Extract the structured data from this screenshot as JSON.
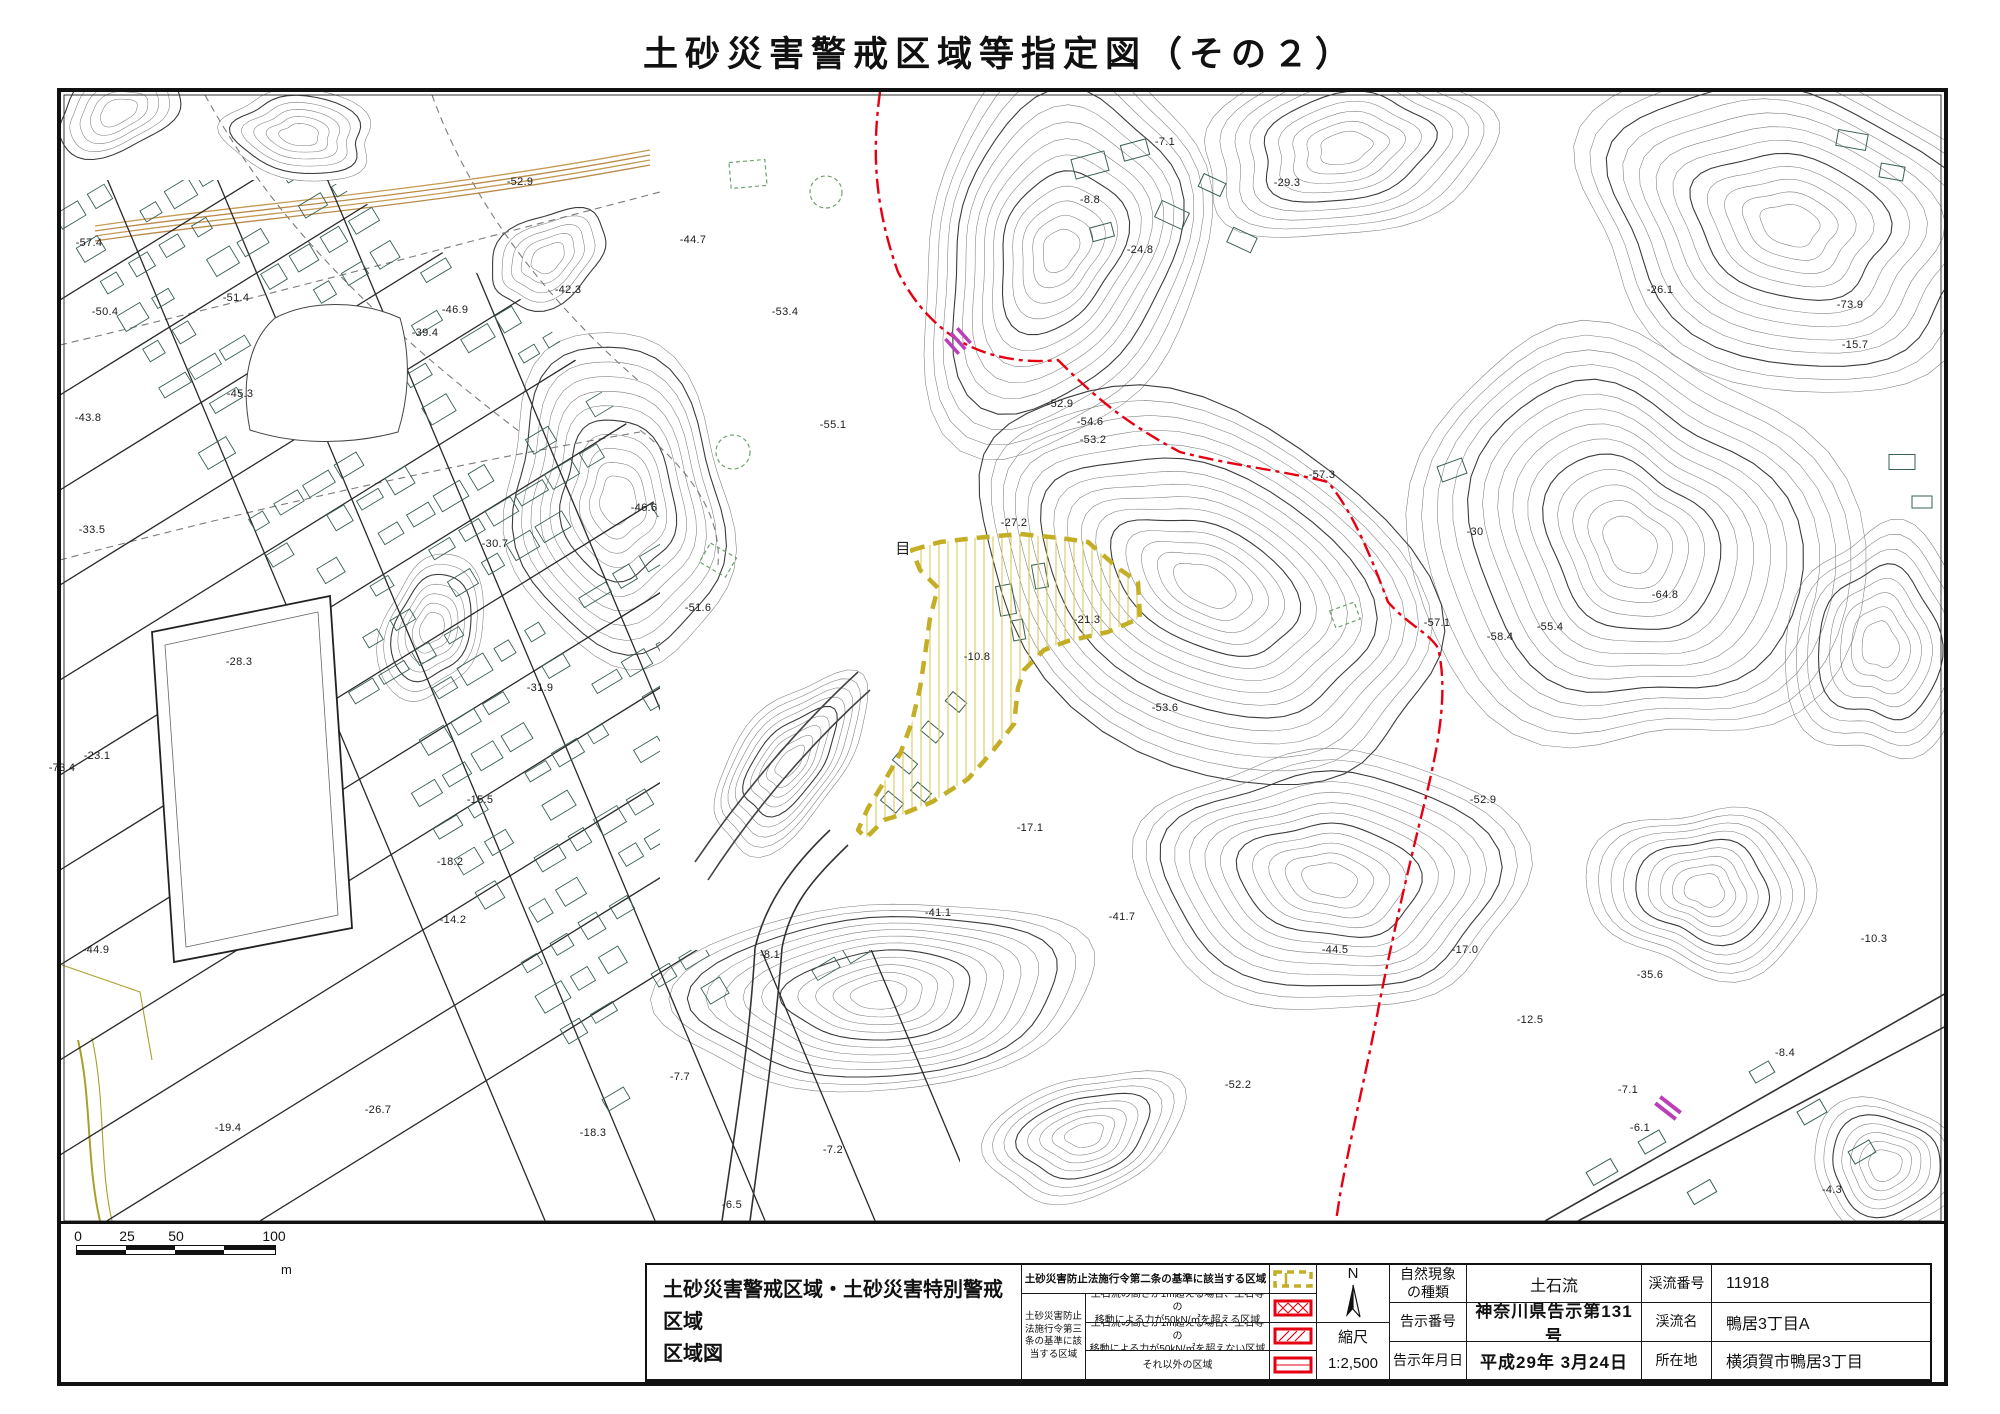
{
  "page": {
    "title": "土砂災害警戒区域等指定図（その２）"
  },
  "scalebar": {
    "ticks": [
      "0",
      "25",
      "50",
      "100"
    ],
    "unit": "m"
  },
  "legend": {
    "title_line1": "土砂災害警戒区域・土砂災害特別警戒区域",
    "title_line2": "区域図",
    "row1_label": "土砂災害防止法施行令第二条の基準に該当する区域",
    "group_label": [
      "土砂災害防止",
      "法施行令第三",
      "条の基準に該",
      "当する区域"
    ],
    "rows": [
      {
        "line1": "土石流の高さが1m超える場合、土石等の",
        "line2": "移動による力が50kN/㎡を超える区域"
      },
      {
        "line1": "土石流の高さが1m超える場合、土石等の",
        "line2": "移動による力が50kN/㎡を超えない区域"
      },
      {
        "line1": "それ以外の区域",
        "line2": ""
      }
    ]
  },
  "compass": {
    "north": "N",
    "scale_label": "縮尺",
    "scale_value": "1:2,500"
  },
  "info": {
    "rows": [
      {
        "l1": "自然現象",
        "l1b": "の種類",
        "v1": "土石流",
        "l2": "渓流番号",
        "v2": "11918"
      },
      {
        "l1": "告示番号",
        "l1b": "",
        "v1": "神奈川県告示第131号",
        "l2": "渓流名",
        "v2": "鴨居3丁目A"
      },
      {
        "l1": "告示年月日",
        "l1b": "",
        "v1": "平成29年 3月24日",
        "l2": "所在地",
        "v2": "横須賀市鴨居3丁目"
      }
    ]
  },
  "colors": {
    "warning_yellow": "#c3ae25",
    "hatch_yellow": "#d4c44e",
    "special_red": "#e60012",
    "boundary_red": "#e60012",
    "building_teal": "#3a5f55",
    "magenta": "#bb3fbb"
  },
  "map": {
    "area_label": {
      "x": 903,
      "y": 548,
      "t": "目"
    },
    "elevation_labels": [
      {
        "x": 89,
        "y": 243,
        "t": "-57.4"
      },
      {
        "x": 105,
        "y": 312,
        "t": "-50.4"
      },
      {
        "x": 236,
        "y": 298,
        "t": "-51.4"
      },
      {
        "x": 88,
        "y": 418,
        "t": "-43.8"
      },
      {
        "x": 240,
        "y": 394,
        "t": "-45.3"
      },
      {
        "x": 92,
        "y": 530,
        "t": "-33.5"
      },
      {
        "x": 239,
        "y": 662,
        "t": "-28.3"
      },
      {
        "x": 97,
        "y": 756,
        "t": "-23.1"
      },
      {
        "x": 62,
        "y": 768,
        "t": "-73.4"
      },
      {
        "x": 96,
        "y": 950,
        "t": "-44.9"
      },
      {
        "x": 228,
        "y": 1128,
        "t": "-19.4"
      },
      {
        "x": 378,
        "y": 1110,
        "t": "-26.7"
      },
      {
        "x": 453,
        "y": 920,
        "t": "-14.2"
      },
      {
        "x": 450,
        "y": 862,
        "t": "-18.2"
      },
      {
        "x": 480,
        "y": 800,
        "t": "-15.5"
      },
      {
        "x": 540,
        "y": 688,
        "t": "-31.9"
      },
      {
        "x": 495,
        "y": 544,
        "t": "-30.7"
      },
      {
        "x": 425,
        "y": 333,
        "t": "-39.4"
      },
      {
        "x": 455,
        "y": 310,
        "t": "-46.9"
      },
      {
        "x": 520,
        "y": 182,
        "t": "-52.9"
      },
      {
        "x": 568,
        "y": 290,
        "t": "-42.3"
      },
      {
        "x": 693,
        "y": 240,
        "t": "-44.7"
      },
      {
        "x": 785,
        "y": 312,
        "t": "-53.4"
      },
      {
        "x": 644,
        "y": 508,
        "t": "-46.6"
      },
      {
        "x": 698,
        "y": 608,
        "t": "-51.6"
      },
      {
        "x": 833,
        "y": 425,
        "t": "-55.1"
      },
      {
        "x": 1060,
        "y": 404,
        "t": "-52.9"
      },
      {
        "x": 1090,
        "y": 422,
        "t": "-54.6"
      },
      {
        "x": 1093,
        "y": 440,
        "t": "-53.2"
      },
      {
        "x": 1014,
        "y": 523,
        "t": "-27.2"
      },
      {
        "x": 977,
        "y": 657,
        "t": "-10.8"
      },
      {
        "x": 1087,
        "y": 620,
        "t": "-21.3"
      },
      {
        "x": 1165,
        "y": 708,
        "t": "-53.6"
      },
      {
        "x": 1030,
        "y": 828,
        "t": "-17.1"
      },
      {
        "x": 938,
        "y": 913,
        "t": "-41.1"
      },
      {
        "x": 1122,
        "y": 917,
        "t": "-41.7"
      },
      {
        "x": 770,
        "y": 955,
        "t": "-8.1"
      },
      {
        "x": 680,
        "y": 1077,
        "t": "-7.7"
      },
      {
        "x": 593,
        "y": 1133,
        "t": "-18.3"
      },
      {
        "x": 732,
        "y": 1205,
        "t": "-6.5"
      },
      {
        "x": 833,
        "y": 1150,
        "t": "-7.2"
      },
      {
        "x": 1238,
        "y": 1085,
        "t": "-52.2"
      },
      {
        "x": 1335,
        "y": 950,
        "t": "-44.5"
      },
      {
        "x": 1465,
        "y": 950,
        "t": "-17.0"
      },
      {
        "x": 1530,
        "y": 1020,
        "t": "-12.5"
      },
      {
        "x": 1650,
        "y": 975,
        "t": "-35.6"
      },
      {
        "x": 1628,
        "y": 1090,
        "t": "-7.1"
      },
      {
        "x": 1640,
        "y": 1128,
        "t": "-6.1"
      },
      {
        "x": 1785,
        "y": 1053,
        "t": "-8.4"
      },
      {
        "x": 1874,
        "y": 939,
        "t": "-10.3"
      },
      {
        "x": 1832,
        "y": 1190,
        "t": "-4.3"
      },
      {
        "x": 1322,
        "y": 475,
        "t": "-57.3"
      },
      {
        "x": 1475,
        "y": 532,
        "t": "-30"
      },
      {
        "x": 1437,
        "y": 623,
        "t": "-57.1"
      },
      {
        "x": 1500,
        "y": 637,
        "t": "-58.4"
      },
      {
        "x": 1550,
        "y": 627,
        "t": "-55.4"
      },
      {
        "x": 1665,
        "y": 595,
        "t": "-64.8"
      },
      {
        "x": 1483,
        "y": 800,
        "t": "-52.9"
      },
      {
        "x": 1165,
        "y": 142,
        "t": "-7.1"
      },
      {
        "x": 1090,
        "y": 200,
        "t": "-8.8"
      },
      {
        "x": 1140,
        "y": 250,
        "t": "-24.8"
      },
      {
        "x": 1287,
        "y": 183,
        "t": "-29.3"
      },
      {
        "x": 1660,
        "y": 290,
        "t": "-26.1"
      },
      {
        "x": 1850,
        "y": 305,
        "t": "-73.9"
      },
      {
        "x": 1855,
        "y": 345,
        "t": "-15.7"
      }
    ]
  }
}
